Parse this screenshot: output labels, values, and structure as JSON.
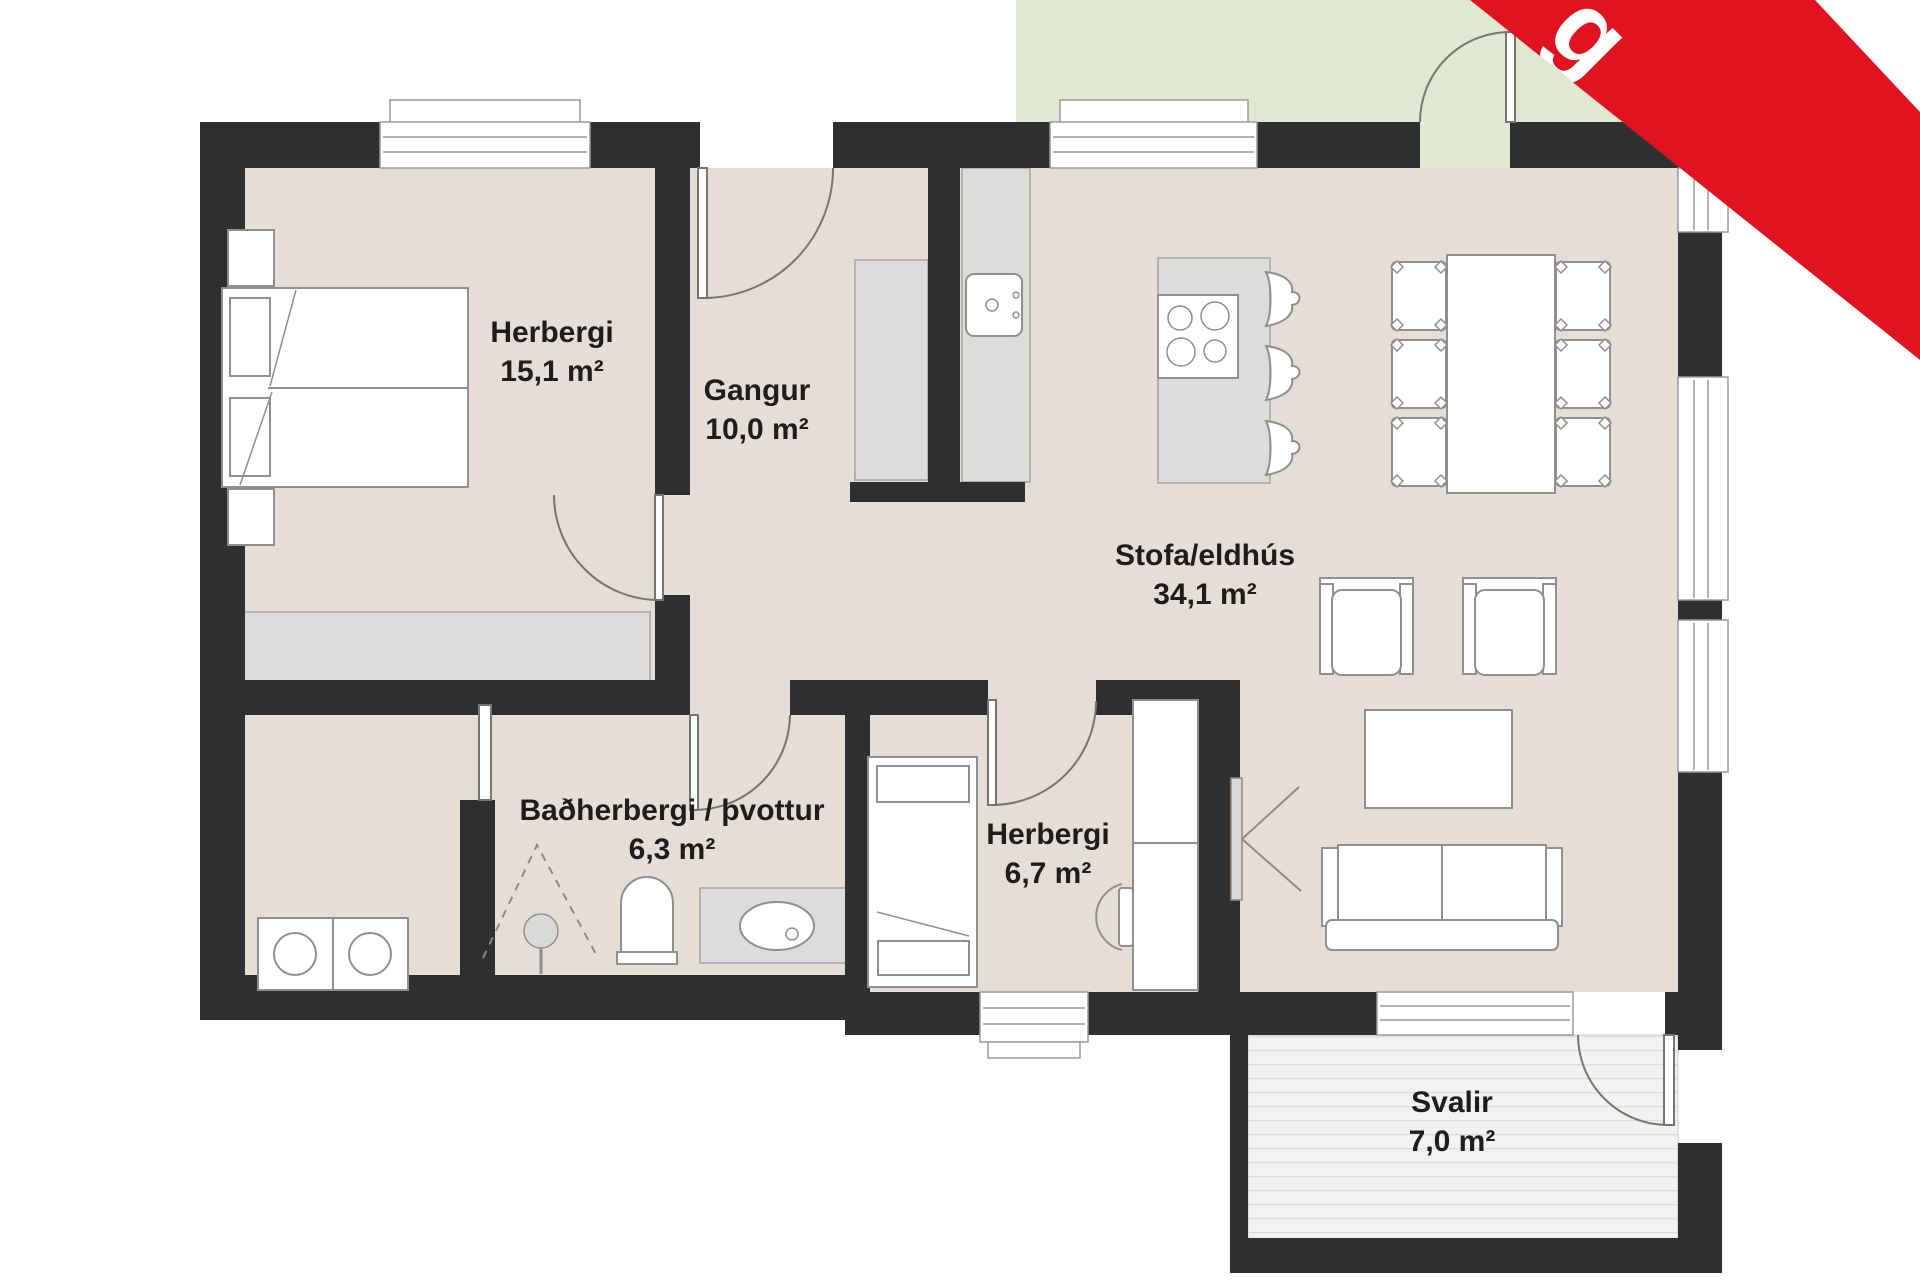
{
  "plan": {
    "rooms": [
      {
        "id": "bedroom-1",
        "name": "Herbergi",
        "area": "15,1 m²"
      },
      {
        "id": "hallway",
        "name": "Gangur",
        "area": "10,0 m²"
      },
      {
        "id": "living-kitchen",
        "name": "Stofa/eldhús",
        "area": "34,1 m²"
      },
      {
        "id": "bathroom-laundry",
        "name": "Baðherbergi / þvottur",
        "area": "6,3 m²"
      },
      {
        "id": "bedroom-2",
        "name": "Herbergi",
        "area": "6,7 m²"
      },
      {
        "id": "balcony",
        "name": "Svalir",
        "area": "7,0 m²"
      }
    ],
    "furniture_icons": [
      "double-bed-icon",
      "nightstand-icon",
      "wardrobe-icon",
      "hall-closet-icon",
      "kitchen-counter-icon",
      "kitchen-sink-icon",
      "kitchen-island-icon",
      "stove-icon",
      "bar-stool-icon",
      "dining-table-icon",
      "dining-chair-icon",
      "armchair-icon",
      "coffee-table-icon",
      "sofa-icon",
      "tv-icon",
      "single-bed-icon",
      "desk-icon",
      "desk-chair-icon",
      "shower-icon",
      "toilet-icon",
      "vanity-sink-icon",
      "washer-icon",
      "dryer-icon",
      "door-swing-icon",
      "sliding-door-icon",
      "window-icon"
    ],
    "colors": {
      "wall": "#2e302f",
      "floor": "#e5ded6",
      "casework": "#dcdcda",
      "casework_border": "#a3a3a1",
      "furniture_stroke": "#8f8f8c",
      "garden_green": "#dfe9d2",
      "deck": "#f2f2f0",
      "deck_stripe": "#dfdddb",
      "label_text": "#1d1d1b",
      "outside": "#ffffff"
    }
  },
  "banner": {
    "text": "g",
    "background": "#e21320",
    "text_color": "#ffffff"
  }
}
